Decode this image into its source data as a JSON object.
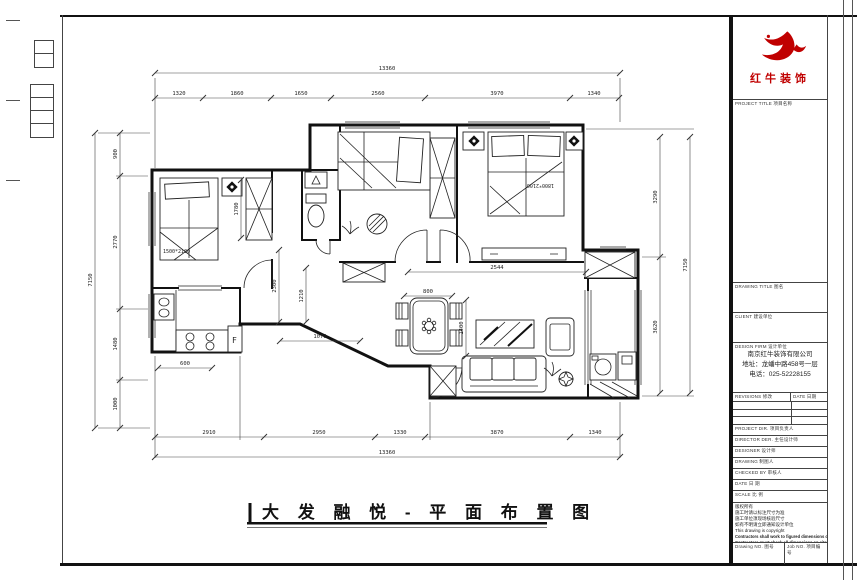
{
  "logo": {
    "brand": "红牛装饰",
    "brand_color": "#c00000"
  },
  "title_block": {
    "project_title_label": "PROJECT TITLE 项目名称",
    "drawing_title_label": "DRAWING TITLE 图名",
    "client_label": "CLIENT 建设单位",
    "design_firm_label": "DESIGN FIRM 设计单位",
    "firm_name": "南京红牛装饰有限公司",
    "firm_address": "地址：龙蟠中路458号一层",
    "firm_phone": "电话：025-52228155",
    "revisions_label": "REVISIONS 修改",
    "date_col_label": "DATE 日期",
    "project_dir_label": "PROJECT DIR. 项目负责人",
    "director_label": "DIRECTOR DER. 主任设计师",
    "designer_label": "DESIGNER 设计师",
    "drawing_by_label": "DRAWING 制图人",
    "checked_by_label": "CHECKED BY 审核人",
    "date_label": "DATE 日 期",
    "scale_label": "SCALE 比 例",
    "notes": [
      "版权所有",
      "施工时请以标注尺寸为准",
      "施工单位须现场核验尺寸",
      "如有不明请立即通知设计单位"
    ],
    "notes_en": [
      "This drawing is copyright",
      "Contractors shall work to figured dimensions only",
      "Contractors must check all dimensions on site",
      "Discrepancies must be reported immediately to architects"
    ],
    "drawing_no_label": "Drawing NO. 图号",
    "job_no_label": "Job NO. 项目编号"
  },
  "plan": {
    "title": "大 发 融 悦 - 平 面 布 置 图",
    "dims": {
      "top_total": "13360",
      "top_segments": [
        "1320",
        "1860",
        "1650",
        "2560",
        "3970",
        "1340"
      ],
      "bottom_segments": [
        "2910",
        "2950",
        "1330",
        "3870",
        "1340"
      ],
      "bottom_total": "13360",
      "left_total": "7150",
      "left_segments": [
        "900",
        "2770",
        "1480",
        "1000"
      ],
      "right_segments": [
        "3290",
        "3620"
      ],
      "right_total": "7150",
      "interior": {
        "entry": "2544",
        "hall": "800",
        "foyer": "1070",
        "kitchen": "600",
        "v1": "2300",
        "v2": "1210",
        "dining": "1400",
        "wardrobe": "1780"
      }
    },
    "labels": {
      "bed1_size": "1500*2100",
      "bed2_size": "1800*2100",
      "fridge": "F"
    }
  }
}
